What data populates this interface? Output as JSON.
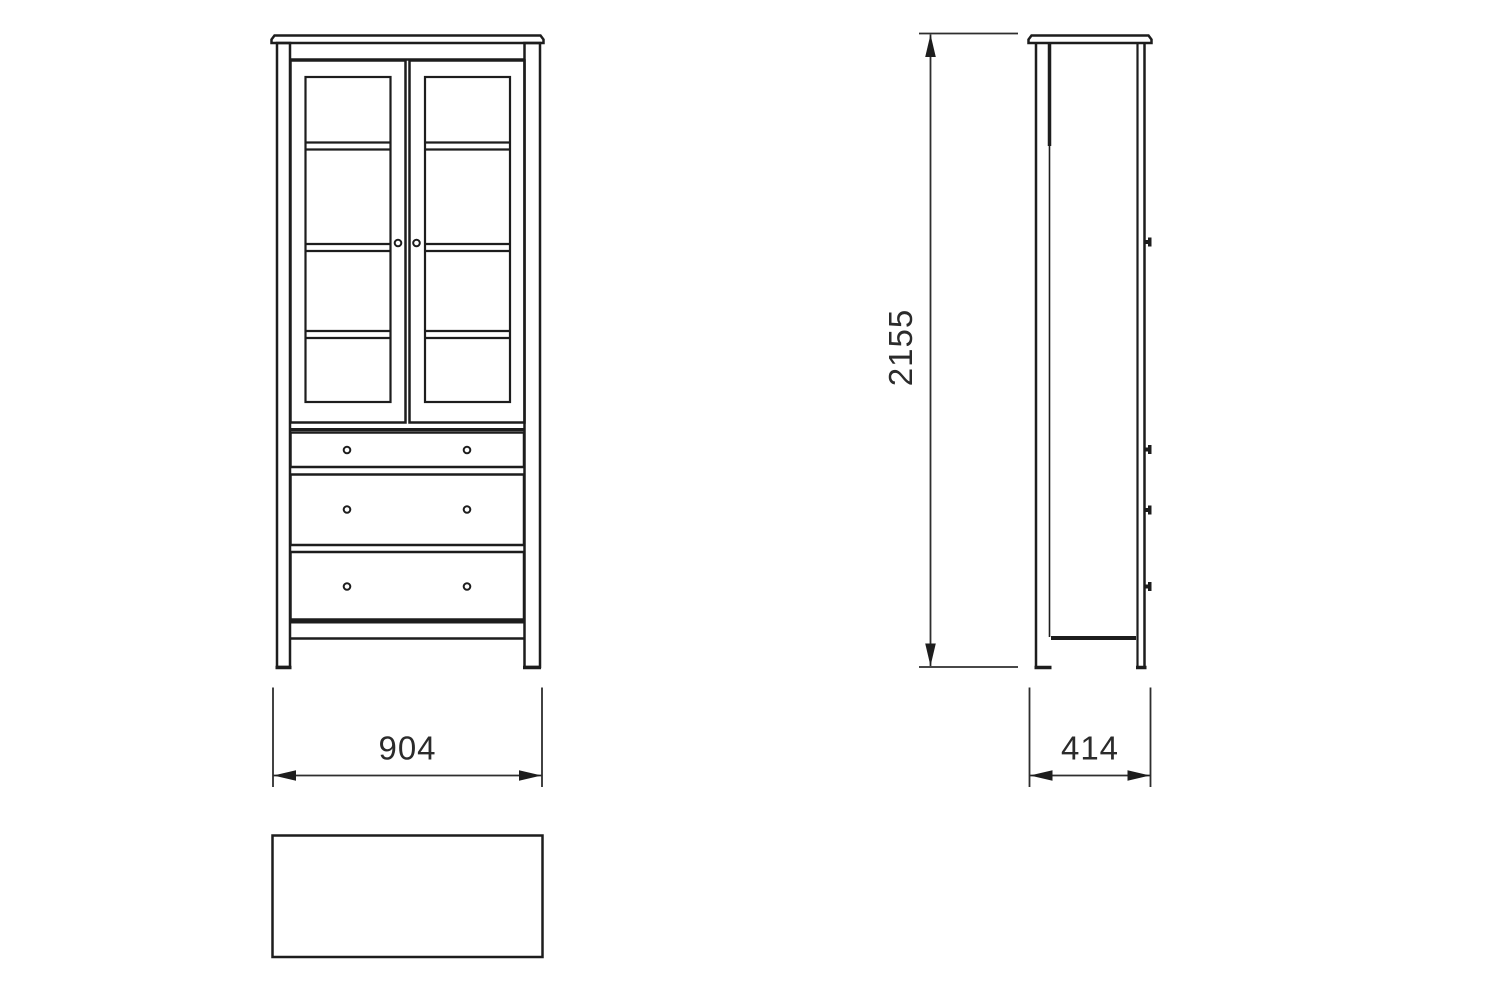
{
  "diagram": {
    "kind": "furniture-technical-drawing",
    "views": {
      "front": {
        "doors": 2,
        "shelf_lines_per_door": 3,
        "drawers": 3,
        "knobs_per_drawer": 2
      },
      "side": {
        "protruding_knobs": 4
      },
      "top": {
        "shape": "rectangle"
      }
    }
  },
  "dimensions": {
    "width_mm": "904",
    "height_mm": "2155",
    "depth_mm": "414"
  },
  "colors": {
    "line": "#1d1d1d",
    "dimension_line": "#2e2e2e",
    "text": "#2b2b2b",
    "background": "#ffffff"
  }
}
